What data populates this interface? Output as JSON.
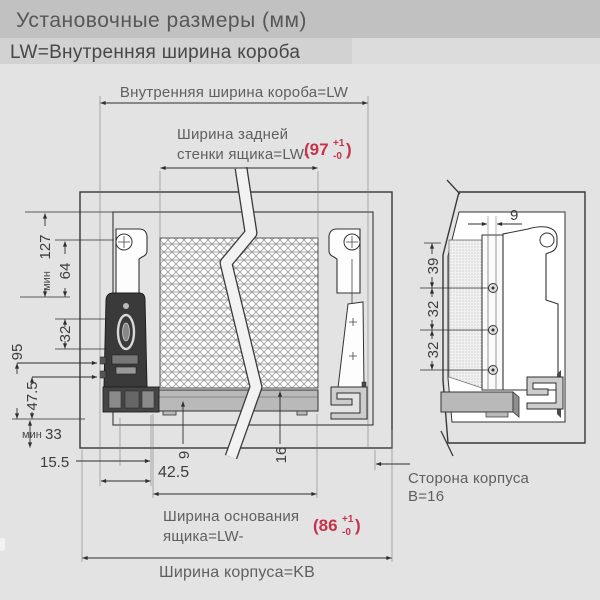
{
  "header": {
    "title": "Установочные размеры (мм)",
    "subtitle": "LW=Внутренняя ширина короба"
  },
  "colors": {
    "accent_red": "#c4334b",
    "line_dark": "#2e2e2e",
    "label_gray": "#5f5f5f",
    "cabinet_gray": "#c6c6c6"
  },
  "front_view": {
    "top_width_label": "Внутренняя ширина короба=LW",
    "back_width_line1": "Ширина задней",
    "back_width_line2": "стенки ящика=LW-",
    "back_width_tol": {
      "open": "(97",
      "sup": "+1",
      "sub": "-0",
      "close": ")"
    },
    "base_width_line1": "Ширина основания",
    "base_width_line2": "ящика=LW-",
    "base_width_tol": {
      "open": "(86",
      "sup": "+1",
      "sub": "-0",
      "close": ")"
    },
    "cabinet_width_label": "Ширина корпуса=KB",
    "dims": {
      "min_prefix_127": "мин",
      "d127": "127",
      "d64": "64",
      "d32": "32",
      "d95": "95",
      "d47_5": "47.5",
      "min_prefix_33": "мин",
      "d33": "33",
      "d15_5": "15.5",
      "d42_5": "42.5",
      "d9": "9",
      "d16": "16"
    }
  },
  "side_view": {
    "d9": "9",
    "d39": "39",
    "d32_upper": "32",
    "d32_lower": "32",
    "side_label_line1": "Сторона корпуса",
    "side_label_line2": "В=16"
  }
}
